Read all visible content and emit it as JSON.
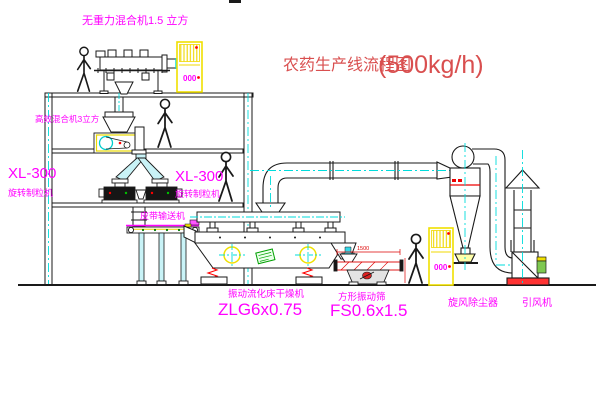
{
  "drawing": {
    "title": "农药生产线流程图",
    "title_capacity": "(500kg/h)",
    "labels": {
      "gravity_mixer": "无重力混合机1.5 立方",
      "high_mixer": "高效混合机3立方",
      "granulator_left_model": "XL-300",
      "granulator_left_name": "旋转制粒机",
      "granulator_mid_model": "XL-300",
      "granulator_mid_name": "旋转制粒机",
      "belt_conveyor": "皮带输送机",
      "dryer_name": "振动流化床干燥机",
      "dryer_model": "ZLG6x0.75",
      "screen_name": "方形振动筛",
      "screen_model": "FS0.6x1.5",
      "cyclone": "旋风除尘器",
      "fan": "引风机",
      "cabinet1_display": "000",
      "cabinet2_display": "000",
      "dim_screen_width": "1500"
    },
    "colors": {
      "label_magenta": "#ff00ff",
      "title_red": "#d94f4f",
      "centerline_cyan": "#00dcdc",
      "cabinet_yellow": "#f0e000",
      "accent_red": "#ff0000",
      "line_black": "#1a1a1a",
      "chute_fill": "#c9f3f7",
      "tag_green": "#00a000"
    }
  }
}
